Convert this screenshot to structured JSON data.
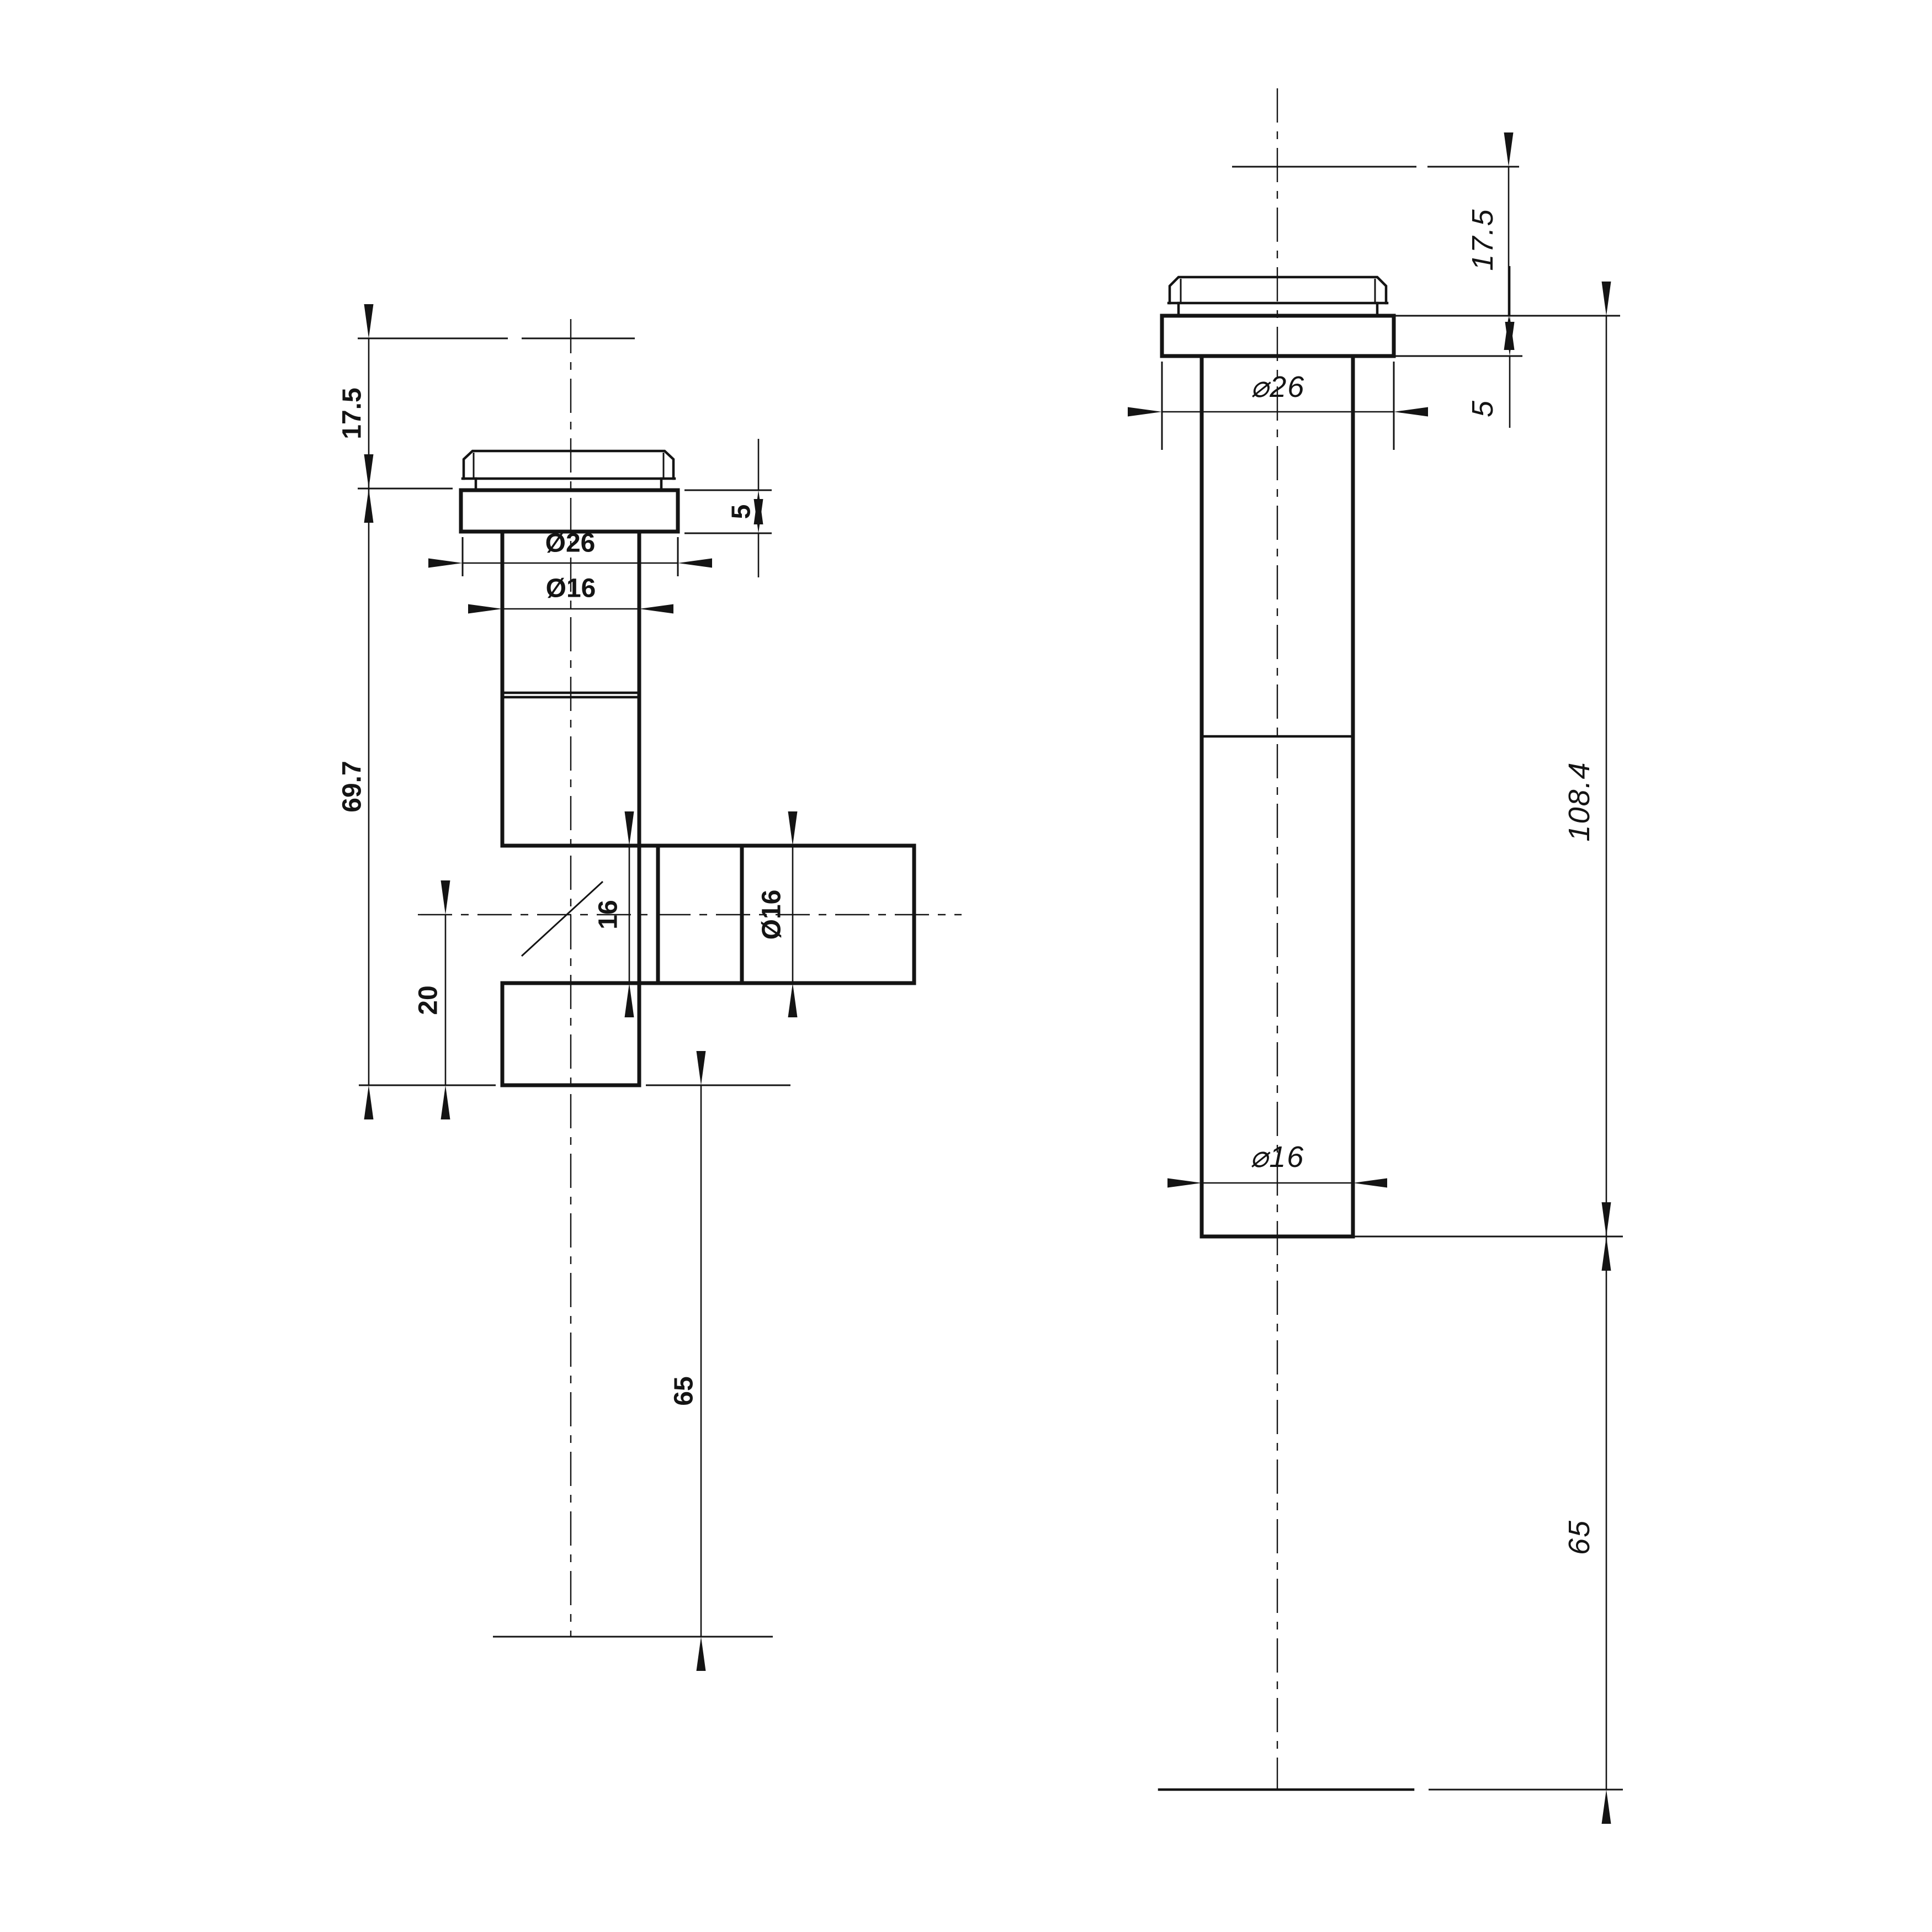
{
  "page": {
    "background": "#ffffff",
    "line_color": "#141414"
  },
  "front_view": {
    "title": "angle-valve-front-view",
    "dims": {
      "top_offset": "17.5",
      "body_length": "69.7",
      "collar_height": "5",
      "flange_diameter": "Ø26",
      "stem_diameter": "Ø16",
      "branch_bore": "16",
      "branch_diameter": "Ø16",
      "outlet_offset": "20",
      "below_mount": "65"
    }
  },
  "side_view": {
    "title": "straight-valve-side-view",
    "dims": {
      "top_offset": "17.5",
      "collar_height": "5",
      "flange_diameter": "⌀26",
      "overall_length": "108.4",
      "tube_diameter": "⌀16",
      "below_mount": "65"
    }
  }
}
